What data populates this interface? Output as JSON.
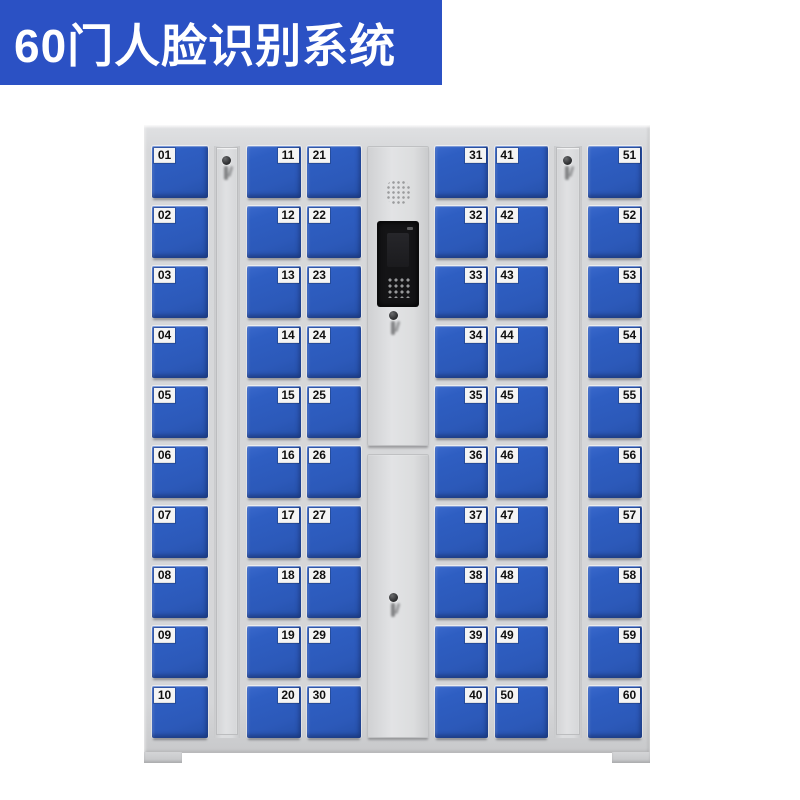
{
  "banner": {
    "title": "60门人脸识别系统",
    "bg_color": "#2b51c4",
    "text_color": "#ffffff"
  },
  "cabinet": {
    "door_color": "#2e5ec2",
    "frame_color": "#d5d6d8",
    "total_doors": 60,
    "columns": [
      {
        "type": "doors",
        "id": "col-a",
        "label_side": "left",
        "doors": [
          "01",
          "02",
          "03",
          "04",
          "05",
          "06",
          "07",
          "08",
          "09",
          "10"
        ]
      },
      {
        "type": "keystrip",
        "id": "ks1"
      },
      {
        "type": "doors",
        "id": "col-b",
        "label_side": "right",
        "doors": [
          "11",
          "12",
          "13",
          "14",
          "15",
          "16",
          "17",
          "18",
          "19",
          "20"
        ]
      },
      {
        "type": "doors",
        "id": "col-c",
        "label_side": "left",
        "doors": [
          "21",
          "22",
          "23",
          "24",
          "25",
          "26",
          "27",
          "28",
          "29",
          "30"
        ]
      },
      {
        "type": "control",
        "id": "ctrl",
        "features": [
          "speaker-grille",
          "face-recognition-screen",
          "camera-window",
          "keypad",
          "key-lock-upper",
          "key-lock-lower"
        ]
      },
      {
        "type": "doors",
        "id": "col-d",
        "label_side": "right",
        "doors": [
          "31",
          "32",
          "33",
          "34",
          "35",
          "36",
          "37",
          "38",
          "39",
          "40"
        ]
      },
      {
        "type": "doors",
        "id": "col-e",
        "label_side": "left",
        "doors": [
          "41",
          "42",
          "43",
          "44",
          "45",
          "46",
          "47",
          "48",
          "49",
          "50"
        ]
      },
      {
        "type": "keystrip",
        "id": "ks2"
      },
      {
        "type": "doors",
        "id": "col-f",
        "label_side": "right",
        "doors": [
          "51",
          "52",
          "53",
          "54",
          "55",
          "56",
          "57",
          "58",
          "59",
          "60"
        ]
      }
    ]
  }
}
